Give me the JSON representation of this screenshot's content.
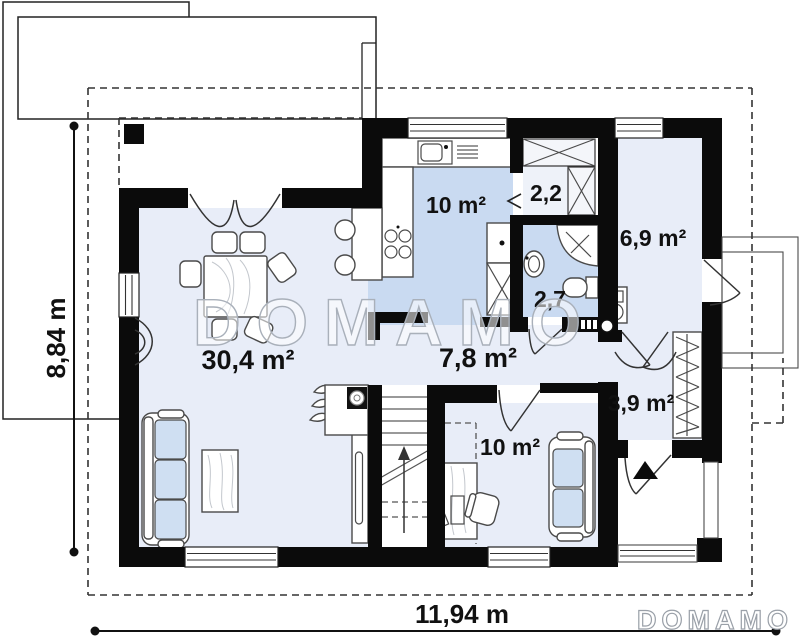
{
  "watermark": {
    "text": "DOMAMO"
  },
  "logo": {
    "text": "DOMAMO"
  },
  "rooms": [
    {
      "id": "kitchen",
      "area_label": "10 m²"
    },
    {
      "id": "pantry",
      "area_label": "2,2"
    },
    {
      "id": "entry-hall",
      "area_label": "6,9 m²"
    },
    {
      "id": "bathroom",
      "area_label": "2,7"
    },
    {
      "id": "living-room",
      "area_label": "30,4 m²"
    },
    {
      "id": "hallway",
      "area_label": "7,8 m²"
    },
    {
      "id": "wardrobe",
      "area_label": "3,9 m²"
    },
    {
      "id": "office",
      "area_label": "10 m²"
    }
  ],
  "dimensions": {
    "height_label": "8,84 m",
    "width_label": "11,94 m"
  },
  "colors": {
    "wall": "#0b0b0b",
    "floor_light": "#e8edf8",
    "floor_medium": "#c9daf1",
    "furniture_blue": "#cfdff2",
    "watermark_outline": "#a9b0ba"
  }
}
